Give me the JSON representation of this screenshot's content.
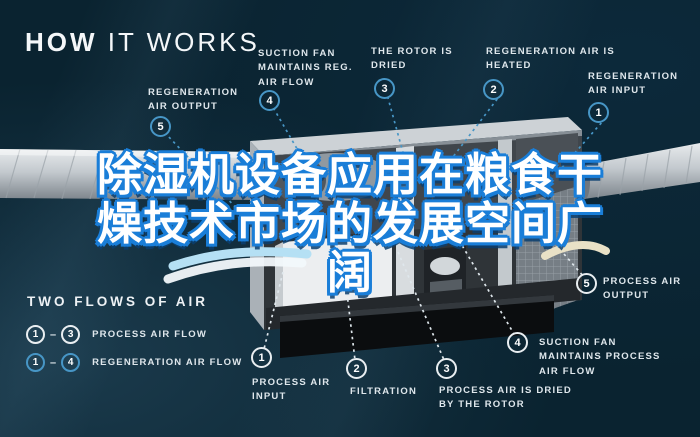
{
  "colors": {
    "bg": "#0a2330",
    "accent-blue": "#4796c6",
    "process-white": "#e9eef1",
    "label-text": "#dfe7ec",
    "overlay-fill": "#ffffff",
    "overlay-outline": "#1a7ed8"
  },
  "header": {
    "title_bold": "HOW",
    "title_rest": " IT WORKS"
  },
  "overlay_title": {
    "line1": "除湿机设备应用在粮食干",
    "line2": "燥技术市场的发展空间广",
    "line3": "阔"
  },
  "regeneration_steps": [
    {
      "num": "1",
      "label": "REGENERATION AIR INPUT"
    },
    {
      "num": "2",
      "label": "REGENERATION AIR IS HEATED"
    },
    {
      "num": "3",
      "label": "THE ROTOR IS DRIED"
    },
    {
      "num": "4",
      "label": "SUCTION FAN MAINTAINS REG. AIR FLOW"
    },
    {
      "num": "5",
      "label": "REGENERATION AIR OUTPUT"
    }
  ],
  "process_steps": [
    {
      "num": "1",
      "label": "PROCESS AIR INPUT"
    },
    {
      "num": "2",
      "label": "FILTRATION"
    },
    {
      "num": "3",
      "label": "PROCESS AIR IS DRIED BY THE ROTOR"
    },
    {
      "num": "4",
      "label": "SUCTION FAN MAINTAINS PROCESS AIR FLOW"
    },
    {
      "num": "5",
      "label": "PROCESS AIR OUTPUT"
    }
  ],
  "legend": {
    "title": "TWO FLOWS OF AIR",
    "separator": "–",
    "rows": [
      {
        "from": "1",
        "to": "3",
        "label": "PROCESS AIR FLOW",
        "flow": "process"
      },
      {
        "from": "1",
        "to": "4",
        "label": "REGENERATION AIR FLOW",
        "flow": "regeneration"
      }
    ]
  }
}
